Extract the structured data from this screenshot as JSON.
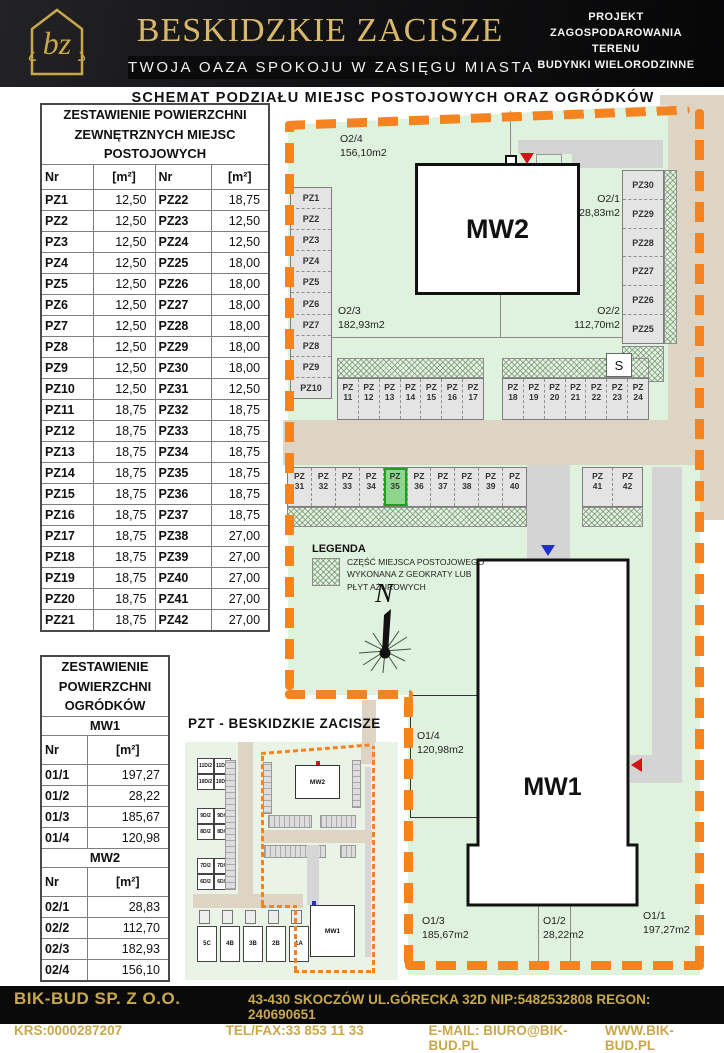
{
  "colors": {
    "accent_orange": "#f5831f",
    "gold": "#d8b86a",
    "map_green": "#dff2dd",
    "road_beige": "#ddd4c3",
    "highlight_green": "#8ed68e",
    "black": "#0a0a0b"
  },
  "header": {
    "logo_text": "bz",
    "title": "BESKIDZKIE ZACISZE",
    "subtitle": "TWOJA OAZA SPOKOJU W ZASIĘGU MIASTA",
    "project_lines": [
      "PROJEKT",
      "ZAGOSPODAROWANIA",
      "TERENU",
      "BUDYNKI WIELORODZINNE"
    ]
  },
  "subheader": "SCHEMAT PODZIAŁU MIEJSC POSTOJOWYCH ORAZ OGRÓDKÓW",
  "parking_table": {
    "title": "ZESTAWIENIE POWIERZCHNI ZEWNĘTRZNYCH MIEJSC POSTOJOWYCH",
    "col_headers": [
      "Nr",
      "[m²]",
      "Nr",
      "[m²]"
    ],
    "rows": [
      [
        "PZ1",
        "12,50",
        "PZ22",
        "18,75"
      ],
      [
        "PZ2",
        "12,50",
        "PZ23",
        "12,50"
      ],
      [
        "PZ3",
        "12,50",
        "PZ24",
        "12,50"
      ],
      [
        "PZ4",
        "12,50",
        "PZ25",
        "18,00"
      ],
      [
        "PZ5",
        "12,50",
        "PZ26",
        "18,00"
      ],
      [
        "PZ6",
        "12,50",
        "PZ27",
        "18,00"
      ],
      [
        "PZ7",
        "12,50",
        "PZ28",
        "18,00"
      ],
      [
        "PZ8",
        "12,50",
        "PZ29",
        "18,00"
      ],
      [
        "PZ9",
        "12,50",
        "PZ30",
        "18,00"
      ],
      [
        "PZ10",
        "12,50",
        "PZ31",
        "12,50"
      ],
      [
        "PZ11",
        "18,75",
        "PZ32",
        "18,75"
      ],
      [
        "PZ12",
        "18,75",
        "PZ33",
        "18,75"
      ],
      [
        "PZ13",
        "18,75",
        "PZ34",
        "18,75"
      ],
      [
        "PZ14",
        "18,75",
        "PZ35",
        "18,75"
      ],
      [
        "PZ15",
        "18,75",
        "PZ36",
        "18,75"
      ],
      [
        "PZ16",
        "18,75",
        "PZ37",
        "18,75"
      ],
      [
        "PZ17",
        "18,75",
        "PZ38",
        "27,00"
      ],
      [
        "PZ18",
        "18,75",
        "PZ39",
        "27,00"
      ],
      [
        "PZ19",
        "18,75",
        "PZ40",
        "27,00"
      ],
      [
        "PZ20",
        "18,75",
        "PZ41",
        "27,00"
      ],
      [
        "PZ21",
        "18,75",
        "PZ42",
        "27,00"
      ]
    ]
  },
  "garden_table": {
    "title": "ZESTAWIENIE POWIERZCHNI OGRÓDKÓW",
    "sections": [
      {
        "name": "MW1",
        "col_headers": [
          "Nr",
          "[m²]"
        ],
        "rows": [
          [
            "01/1",
            "197,27"
          ],
          [
            "01/2",
            "28,22"
          ],
          [
            "01/3",
            "185,67"
          ],
          [
            "01/4",
            "120,98"
          ]
        ]
      },
      {
        "name": "MW2",
        "col_headers": [
          "Nr",
          "[m²]"
        ],
        "rows": [
          [
            "02/1",
            "28,83"
          ],
          [
            "02/2",
            "112,70"
          ],
          [
            "02/3",
            "182,93"
          ],
          [
            "02/4",
            "156,10"
          ]
        ]
      }
    ]
  },
  "map": {
    "buildings": {
      "mw2": "MW2",
      "mw1": "MW1"
    },
    "gardens": [
      {
        "id": "O2/4",
        "area": "156,10m2"
      },
      {
        "id": "O2/1",
        "area": "28,83m2"
      },
      {
        "id": "O2/3",
        "area": "182,93m2"
      },
      {
        "id": "O2/2",
        "area": "112,70m2"
      },
      {
        "id": "O1/4",
        "area": "120,98m2"
      },
      {
        "id": "O1/3",
        "area": "185,67m2"
      },
      {
        "id": "O1/2",
        "area": "28,22m2"
      },
      {
        "id": "O1/1",
        "area": "197,27m2"
      }
    ],
    "stalls_left": [
      "PZ1",
      "PZ2",
      "PZ3",
      "PZ4",
      "PZ5",
      "PZ6",
      "PZ7",
      "PZ8",
      "PZ9",
      "PZ10"
    ],
    "stalls_right_col": [
      "PZ30",
      "PZ29",
      "PZ28",
      "PZ27",
      "PZ26",
      "PZ25"
    ],
    "stalls_row1": [
      "PZ\n11",
      "PZ\n12",
      "PZ\n13",
      "PZ\n14",
      "PZ\n15",
      "PZ\n16",
      "PZ\n17"
    ],
    "stalls_row2": [
      "PZ\n18",
      "PZ\n19",
      "PZ\n20",
      "PZ\n21",
      "PZ\n22",
      "PZ\n23",
      "PZ\n24"
    ],
    "stalls_row3": [
      "PZ\n31",
      "PZ\n32",
      "PZ\n33",
      "PZ\n34",
      "PZ\n35",
      "PZ\n36",
      "PZ\n37",
      "PZ\n38",
      "PZ\n39",
      "PZ\n40"
    ],
    "stalls_row4": [
      "PZ\n41",
      "PZ\n42"
    ],
    "highlighted_stall": "PZ\n35",
    "s_box": "S",
    "north": "N",
    "legend": {
      "title": "LEGENDA",
      "lines": [
        "CZĘŚĆ MIEJSCA POSTOJOWEGO",
        "WYKONANA Z GEOKRATY LUB",
        "PŁYT AŻUROWYCH"
      ]
    }
  },
  "inset": {
    "title": "PZT - BESKIDZKIE ZACISZE",
    "house_groups": [
      [
        "11D/2",
        "11D/1",
        "10D/2",
        "10D/1"
      ],
      [
        "9D/2",
        "9D/1",
        "8D/2",
        "8D/1"
      ],
      [
        "7D/2",
        "7D/1",
        "6D/2",
        "6D/1"
      ]
    ],
    "row_houses": [
      "5C",
      "4B",
      "3B",
      "2B",
      "1A"
    ],
    "buildings": {
      "mw2": "MW2",
      "mw1": "MW1"
    }
  },
  "footer": {
    "company": "BIK-BUD SP. Z O.O.",
    "address": "43-430 SKOCZÓW UL.GÓRECKA 32D NIP:5482532808 REGON: 240690651",
    "krs": "KRS:0000287207",
    "tel": "TEL/FAX:33 853 11 33",
    "email": "E-MAIL: BIURO@BIK-BUD.PL",
    "www": "WWW.BIK-BUD.PL"
  }
}
